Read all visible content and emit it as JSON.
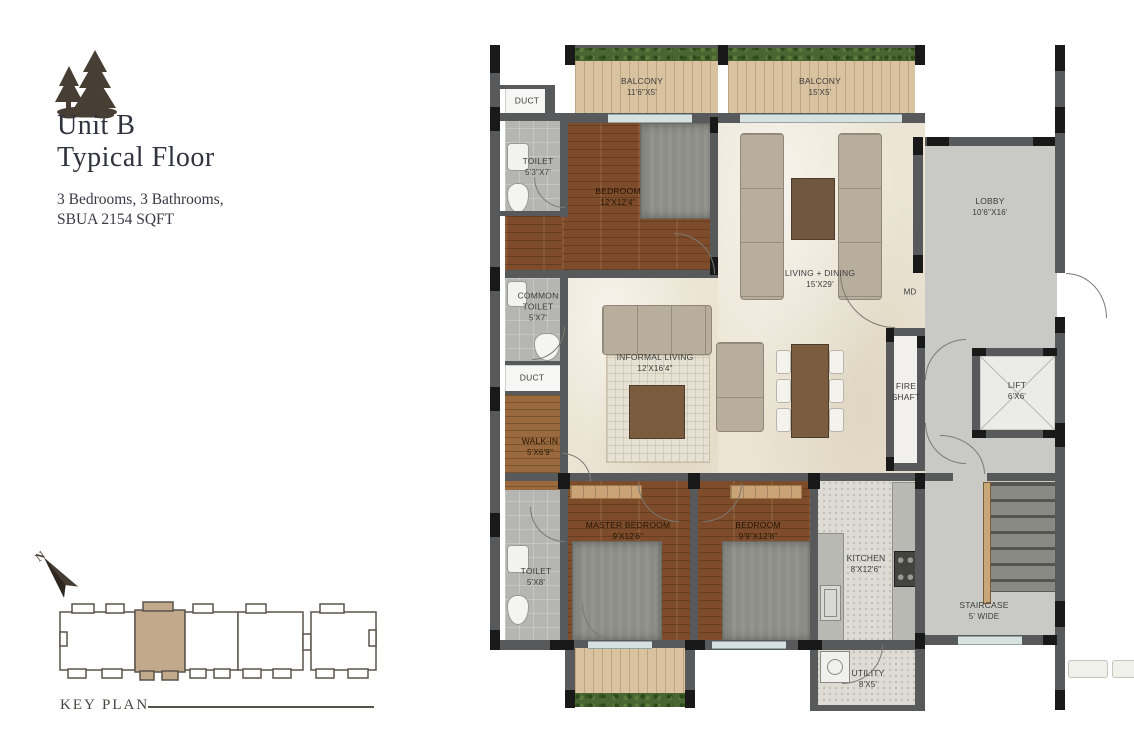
{
  "meta": {
    "title_line1": "Unit B",
    "title_line2": "Typical Floor",
    "subtitle_line1": "3 Bedrooms, 3 Bathrooms,",
    "subtitle_line2": "SBUA 2154 SQFT"
  },
  "icons": {
    "logo": "pine-trees-logo",
    "north": "north-compass-arrow"
  },
  "key_plan": {
    "label": "KEY PLAN",
    "north_label": "N",
    "highlight_color": "#c3a98b"
  },
  "colors": {
    "wall": "#58595b",
    "column": "#191919",
    "wood_floor": "#7e4c2a",
    "balcony_wood": "#d9c2a0",
    "marble": "#ebe4d3",
    "lobby_gray": "#c9c9c5",
    "toilet_tile": "#b5b5b2",
    "kitchen_tile": "#dddbd4",
    "plants_green": "#4a6531",
    "title_text": "#32323e",
    "label_text": "#3c3c3c"
  },
  "rooms": {
    "balcony1": {
      "name": "BALCONY",
      "dim": "11'6\"X5'"
    },
    "balcony2": {
      "name": "BALCONY",
      "dim": "15'X5'"
    },
    "duct1": {
      "name": "DUCT"
    },
    "toilet1": {
      "name": "TOILET",
      "dim": "5'3\"X7'"
    },
    "bedroom1": {
      "name": "BEDROOM",
      "dim": "12'X12'4\""
    },
    "living": {
      "name": "LIVING + DINING",
      "dim": "15'X29'"
    },
    "lobby": {
      "name": "LOBBY",
      "dim": "10'6\"X16'"
    },
    "md": {
      "name": "MD"
    },
    "common_toilet": {
      "name1": "COMMON",
      "name2": "TOILET",
      "dim": "5'X7'"
    },
    "duct2": {
      "name": "DUCT"
    },
    "informal": {
      "name": "INFORMAL LIVING",
      "dim": "12'X16'4\""
    },
    "walkin": {
      "name": "WALK-IN",
      "dim": "5'X6'9\""
    },
    "fire_shaft": {
      "name1": "FIRE",
      "name2": "SHAFT"
    },
    "lift": {
      "name": "LIFT",
      "dim": "6'X6'"
    },
    "master": {
      "name": "MASTER BEDROOM",
      "dim": "9'X12'6\""
    },
    "bedroom2": {
      "name": "BEDROOM",
      "dim": "9'9\"X12'8\""
    },
    "toilet2": {
      "name": "TOILET",
      "dim": "5'X8'"
    },
    "kitchen": {
      "name": "KITCHEN",
      "dim": "8'X12'6\""
    },
    "staircase": {
      "name": "STAIRCASE",
      "dim": "5' WIDE"
    },
    "utility": {
      "name": "UTILITY",
      "dim": "8'X5'"
    }
  }
}
